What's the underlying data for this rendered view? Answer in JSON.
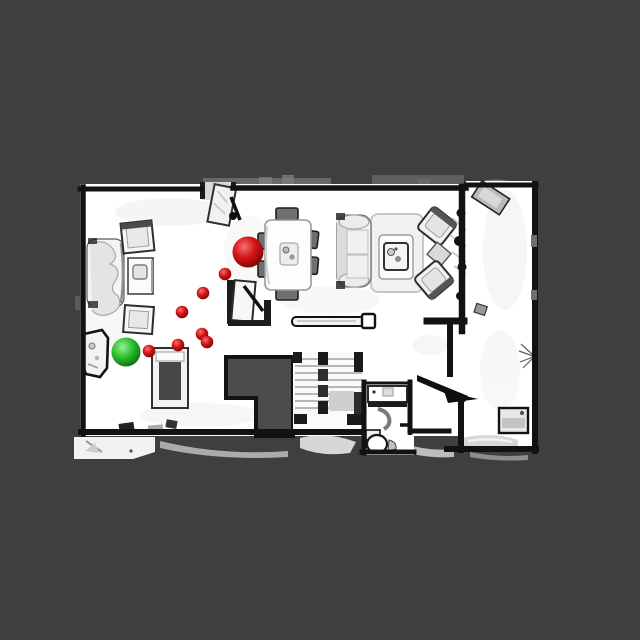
{
  "canvas": {
    "width": 640,
    "height": 640
  },
  "scene": {
    "type": "top-down-3d-scan-floorplan-with-navigation-path",
    "background_color": "#3f3f41",
    "floor_color": "#ffffff",
    "wall_color": "#121212",
    "void_color": "#4b4b4d",
    "rooms": [
      "living-room-left",
      "living-room-right",
      "dining-area",
      "entry-hall",
      "bathroom",
      "stair-hall"
    ]
  },
  "markers": {
    "start": {
      "id": "start-marker",
      "shape": "sphere",
      "color": "#2fbe2f",
      "highlight": "#94f094",
      "edge": "#0d6e0d",
      "x": 126,
      "y": 352,
      "r": 14.5
    },
    "goal": {
      "id": "goal-marker",
      "shape": "sphere",
      "color": "#d31414",
      "highlight": "#f47070",
      "edge": "#7c0606",
      "x": 248,
      "y": 252,
      "r": 15.5
    },
    "waypoints": {
      "id": "path-waypoint",
      "shape": "sphere",
      "color": "#d31414",
      "highlight": "#f47070",
      "edge": "#7c0606",
      "r": 6.3,
      "points": [
        {
          "x": 149,
          "y": 351
        },
        {
          "x": 178,
          "y": 345
        },
        {
          "x": 202,
          "y": 334
        },
        {
          "x": 207,
          "y": 342
        },
        {
          "x": 182,
          "y": 312
        },
        {
          "x": 203,
          "y": 293
        },
        {
          "x": 225,
          "y": 274
        }
      ]
    }
  },
  "objects": [
    "left-sofa",
    "left-armchair-top",
    "left-coffee-table",
    "left-armchair-bottom",
    "top-door",
    "dining-table",
    "dining-chairs",
    "display-easel",
    "floor-board",
    "right-sofa",
    "area-rug",
    "right-coffee-table",
    "right-armchair-top",
    "right-armchair-bottom",
    "right-side-table",
    "entry-shelf",
    "entry-bench",
    "entry-mat",
    "stairwell-void",
    "staircase",
    "stair-landing",
    "bathroom-counter",
    "toilet",
    "open-door",
    "hall-side-table",
    "lounge-chair"
  ]
}
